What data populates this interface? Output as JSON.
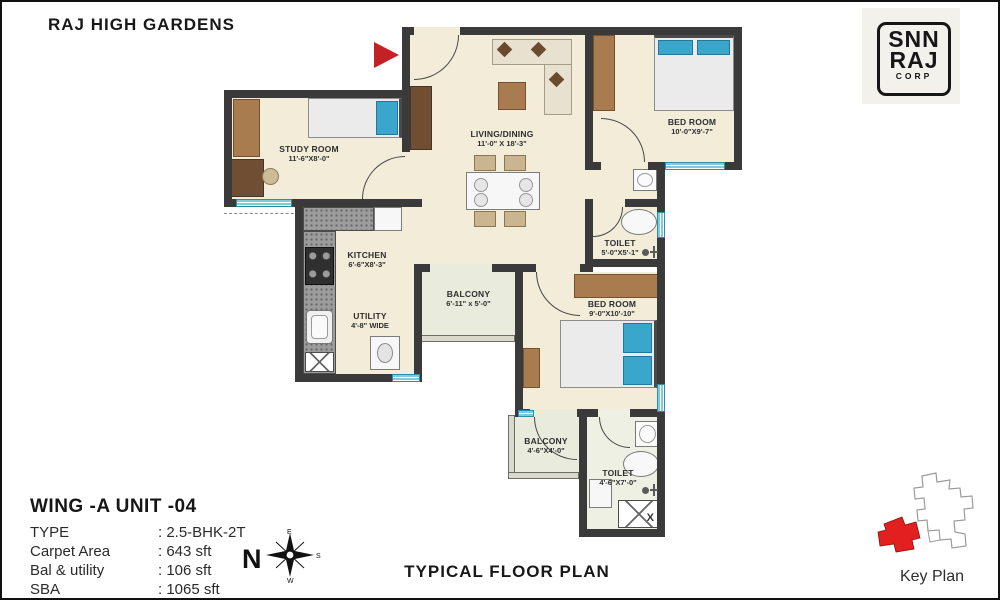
{
  "page": {
    "title": "RAJ HIGH GARDENS",
    "footer_title": "TYPICAL FLOOR PLAN",
    "key_plan_label": "Key Plan"
  },
  "logo": {
    "line1": "SNN",
    "line2": "RAJ",
    "line3": "CORP"
  },
  "unit_info": {
    "heading": "WING -A  UNIT -04",
    "rows": [
      {
        "label": "TYPE",
        "value": ": 2.5-BHK-2T"
      },
      {
        "label": "Carpet Area",
        "value": ": 643 sft"
      },
      {
        "label": "Bal & utility",
        "value": ": 106 sft"
      },
      {
        "label": "SBA",
        "value": ": 1065 sft"
      }
    ]
  },
  "compass": {
    "n": "N",
    "e": "E",
    "s": "S",
    "w": "W"
  },
  "rooms": {
    "study": {
      "name": "STUDY ROOM",
      "dims": "11'-6\"X8'-0\""
    },
    "living": {
      "name": "LIVING/DINING",
      "dims": "11'-0\" X 18'-3\""
    },
    "bedroom1": {
      "name": "BED ROOM",
      "dims": "10'-0\"X9'-7\""
    },
    "toilet1": {
      "name": "TOILET",
      "dims": "5'-0\"X5'-1\""
    },
    "kitchen": {
      "name": "KITCHEN",
      "dims": "6'-6\"X8'-3\""
    },
    "utility": {
      "name": "UTILITY",
      "dims": "4'-8\" WIDE"
    },
    "balcony1": {
      "name": "BALCONY",
      "dims": "6'-11\" x 5'-0\""
    },
    "bedroom2": {
      "name": "BED ROOM",
      "dims": "9'-0\"X10'-10\""
    },
    "balcony2": {
      "name": "BALCONY",
      "dims": "4'-6\"X4'-0\""
    },
    "toilet2": {
      "name": "TOILET",
      "dims": "4'-6\"X7'-0\""
    },
    "shaft": {
      "label": "X"
    }
  },
  "colors": {
    "wall": "#3a3a3a",
    "floor": "#f2ecd9",
    "balcony_floor": "#e9ebdc",
    "window_teal": "#7ecbdb",
    "wood_brown": "#a97c50",
    "pillow_blue": "#3aa6cc",
    "entrance_arrow_red": "#c42127",
    "key_plan_red": "#e32020",
    "logo_bg": "#f3f1ec"
  }
}
